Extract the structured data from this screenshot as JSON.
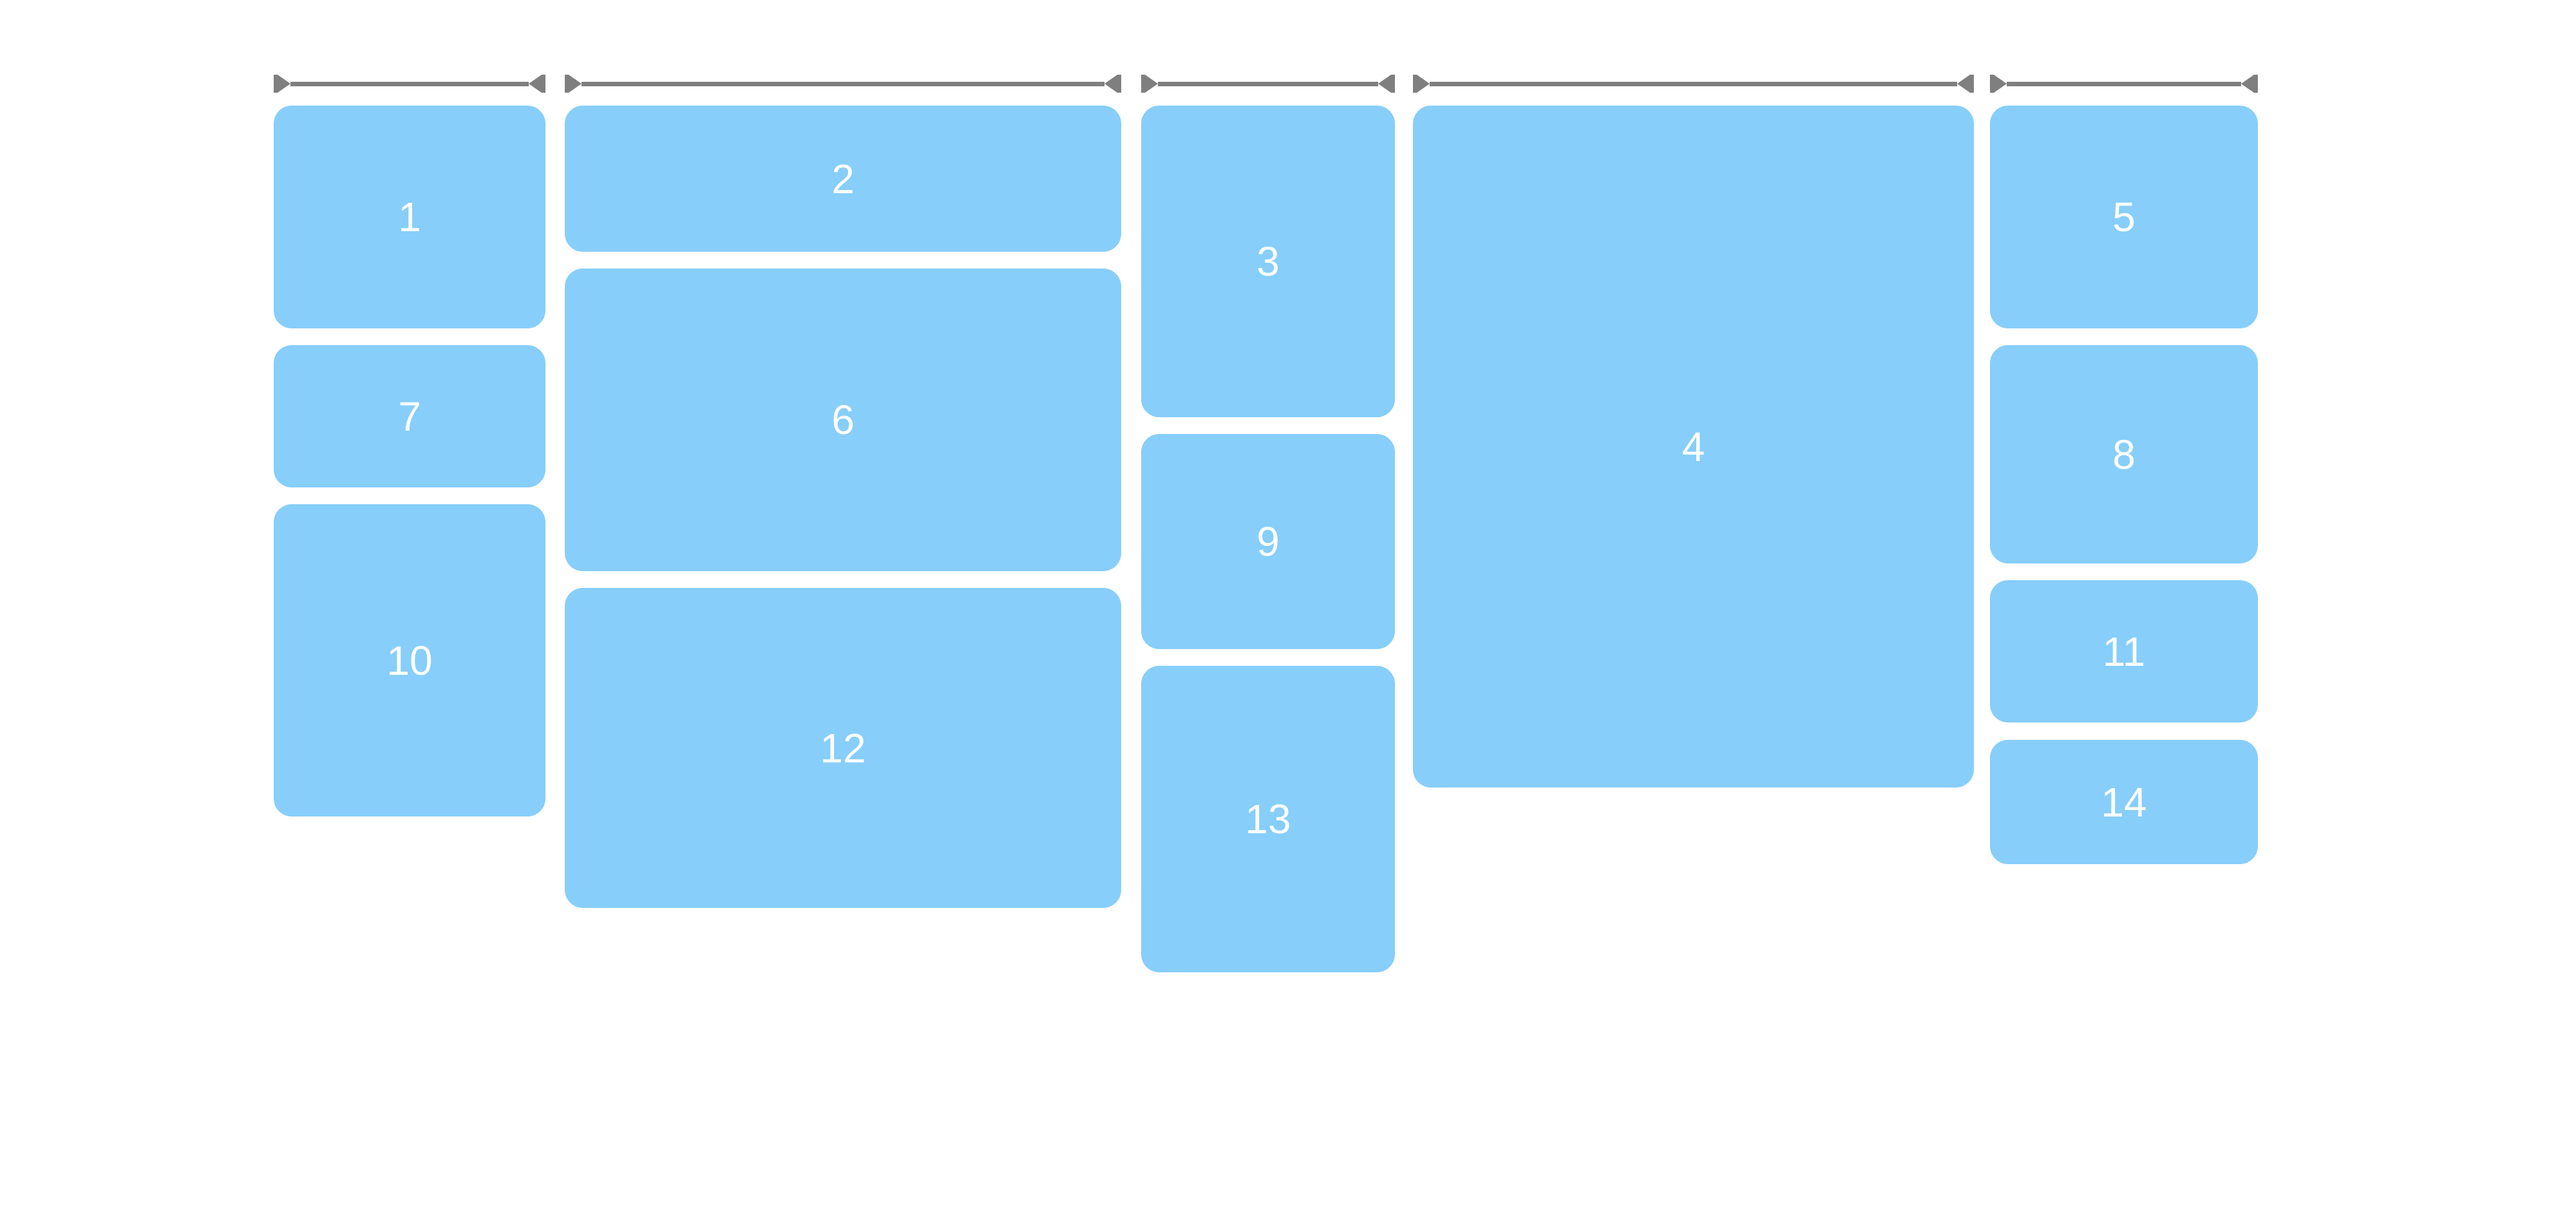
{
  "canvas": {
    "background": "#ffffff"
  },
  "colors": {
    "tile": "#87cefa",
    "label": "#ffffff",
    "ruler": "#7f7f7f"
  },
  "rulers": {
    "count": 5,
    "style": "horizontal dimension line with end ticks and inward-pointing arrowheads"
  },
  "masonry": {
    "items": [
      {
        "label": "1"
      },
      {
        "label": "2"
      },
      {
        "label": "3"
      },
      {
        "label": "4"
      },
      {
        "label": "5"
      },
      {
        "label": "6"
      },
      {
        "label": "7"
      },
      {
        "label": "8"
      },
      {
        "label": "9"
      },
      {
        "label": "10"
      },
      {
        "label": "11"
      },
      {
        "label": "12"
      },
      {
        "label": "13"
      },
      {
        "label": "14"
      }
    ]
  }
}
